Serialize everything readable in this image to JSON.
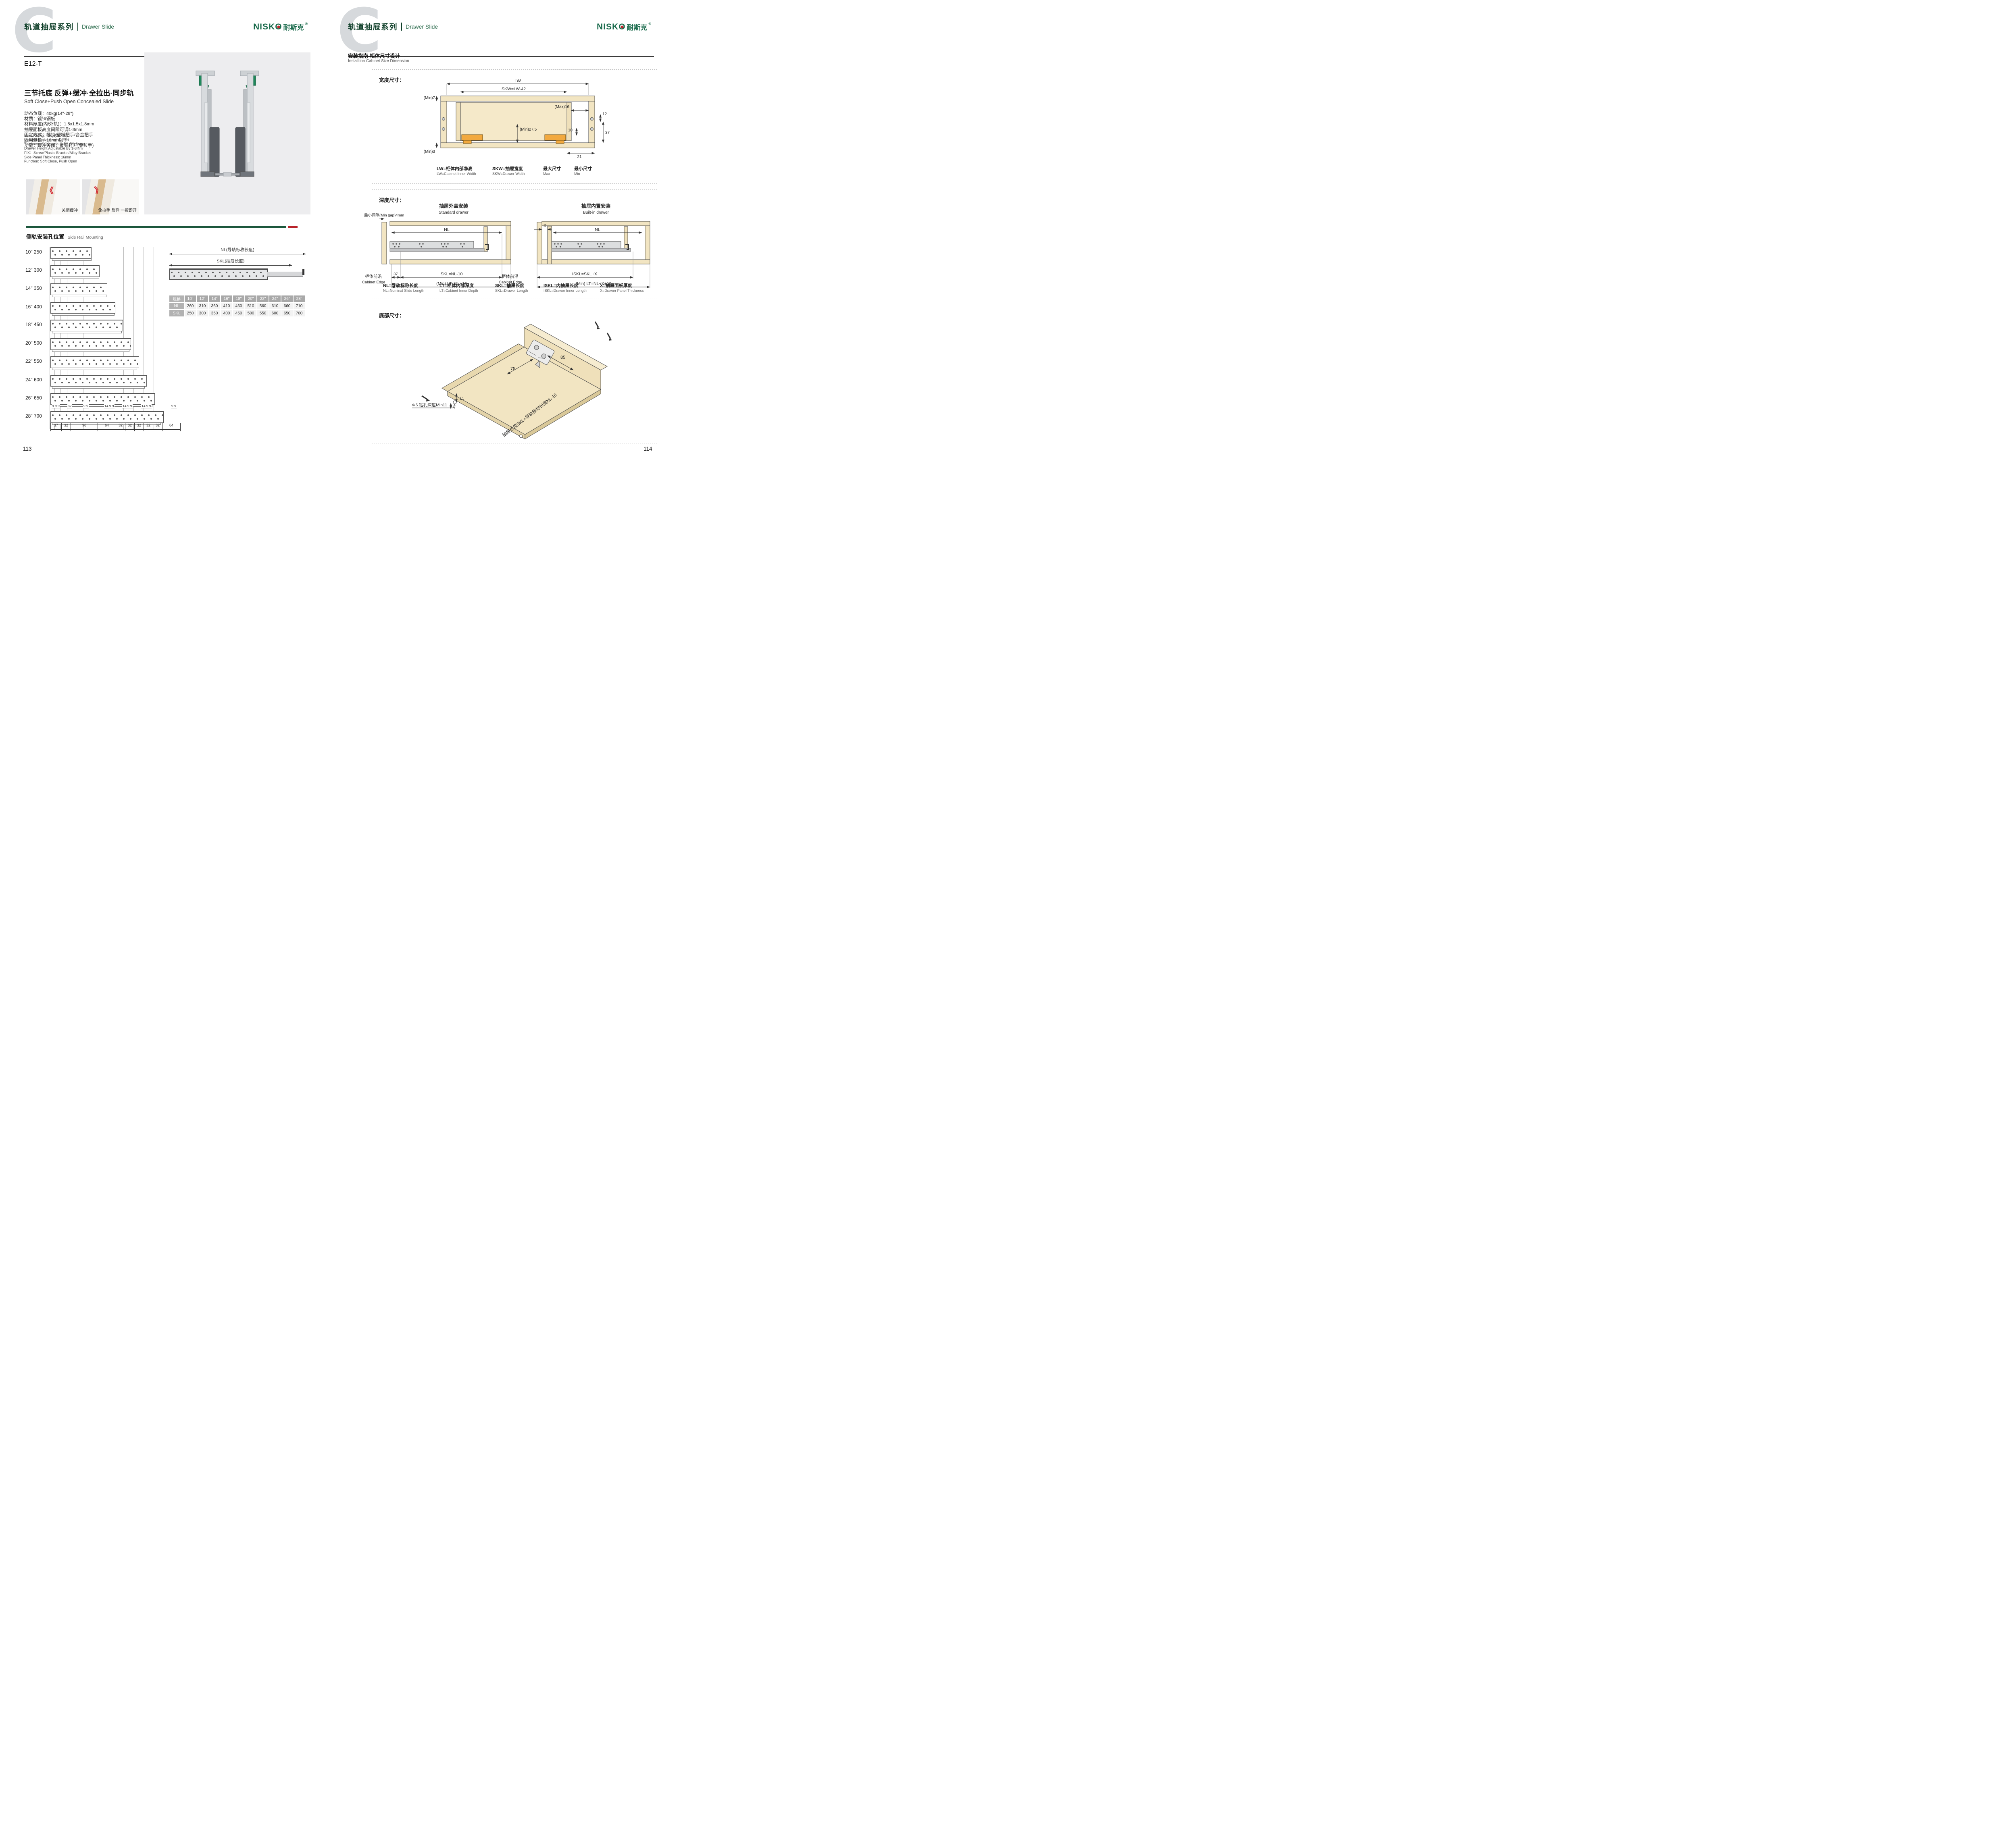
{
  "header": {
    "watermark": "C",
    "series_cn": "轨道抽屉系列",
    "series_en": "Drawer Slide"
  },
  "logo": {
    "en_head": "NISK",
    "en_o": "O",
    "cn": "耐斯克",
    "reg": "®"
  },
  "colors": {
    "brand_green": "#1a6b4c",
    "header_green": "#10402a",
    "rule_green": "#174f36",
    "accent_red": "#b8232a",
    "wood_tan": "#f2e5c2",
    "bracket_orange": "#f2a93f",
    "table_gray": "#a9a9a9"
  },
  "left_page": {
    "page_number": "113",
    "model": "E12-T",
    "title_cn": "三节托底 反弹+缓冲·全拉出·同步轨",
    "title_en": "Soft Close+Push Open Concealed Slide",
    "specs_cn": [
      "动态负载：40kg(14\"-28\")",
      "材质：镀锌钢板",
      "材料厚度(内/外轨)：1.5x1.5x1.8mm",
      "抽屉面板高度间隙可调1-3mm",
      "固定方式：插销/塑料把手/合金把手",
      "适用侧板：16mm以下",
      "功能：缓冲关闭，反弹打开(免拉手)"
    ],
    "specs_en": [
      "Load Rating: 40kg (14\"-28)",
      "Material: Galvanized Sheed",
      "Thickness Of Materia (1.5/1.5/1.8mm)",
      "Drawer Height Adjustable By 1-3mm",
      "FIX：Screw/Plastic Bracket/Alloy Bracket",
      "Side Panel Thickness: 16mm",
      "Function: Soft Close, Push Open"
    ],
    "photo_captions": [
      "关闭缓冲",
      "免拉手 反弹 一按即开"
    ],
    "rail_section": {
      "cn": "侧轨安装孔位置",
      "en": "Side Rail Mounting"
    },
    "rail_rows": [
      {
        "inch": "10\"",
        "mm": "250"
      },
      {
        "inch": "12\"",
        "mm": "300"
      },
      {
        "inch": "14\"",
        "mm": "350"
      },
      {
        "inch": "16\"",
        "mm": "400"
      },
      {
        "inch": "18\"",
        "mm": "450"
      },
      {
        "inch": "20\"",
        "mm": "500"
      },
      {
        "inch": "22\"",
        "mm": "550"
      },
      {
        "inch": "24\"",
        "mm": "600"
      },
      {
        "inch": "26\"",
        "mm": "650"
      },
      {
        "inch": "28\"",
        "mm": "700"
      }
    ],
    "rail_top_dims": [
      "9 9 9",
      "32",
      "9 9",
      "14 9 9",
      "14 9 9",
      "14 9 9",
      "9 9"
    ],
    "rail_bottom_dims": [
      37,
      32,
      96,
      64,
      32,
      32,
      32,
      32,
      32,
      64
    ],
    "slide_dims": {
      "nl": "NL(导轨标称长度)",
      "skl": "SKL(抽屉长度)"
    },
    "size_table": {
      "spec_label": "规格",
      "cols": [
        "10\"",
        "12\"",
        "14\"",
        "16\"",
        "18\"",
        "20\"",
        "22\"",
        "24\"",
        "26\"",
        "28\""
      ],
      "nl_label": "NL",
      "nl": [
        260,
        310,
        360,
        410,
        460,
        510,
        560,
        610,
        660,
        710
      ],
      "skl_label": "SKL",
      "skl": [
        250,
        300,
        350,
        400,
        450,
        500,
        550,
        600,
        650,
        700
      ]
    }
  },
  "right_page": {
    "page_number": "114",
    "guide_title_cn": "安装指南-柜体尺寸设计",
    "guide_title_en": "Installtion Cabinet Size Dimension",
    "width_box": {
      "title": "宽度尺寸：",
      "dims": {
        "lw": "LW",
        "skw": "SKW=LW-42",
        "min7": "(Min)7",
        "max16": "(Max)16",
        "d12": "12",
        "d10": "10",
        "d37": "37",
        "min275": "(Min)27.5",
        "min3": "(Min)3",
        "d21": "21"
      },
      "legend": [
        {
          "cn": "LW=柜体内部净高",
          "en": "LW=Cabinet Inner Width"
        },
        {
          "cn": "SKW=抽屉宽度",
          "en": "SKW=Drawer Width"
        },
        {
          "cn": "最大尺寸",
          "en": "Max"
        },
        {
          "cn": "最小尺寸",
          "en": "Min"
        }
      ]
    },
    "depth_box": {
      "title": "深度尺寸：",
      "gap_label": "最小间隙(Min gap)4mm",
      "standard": {
        "cn": "抽屉外盖安装",
        "en": "Standard drawer",
        "nl": "NL",
        "d37": "37",
        "skl": "SKL=NL-10",
        "lt": "(Min) LT=NL+10",
        "edge_cn": "柜体前沿",
        "edge_en": "Cabinet Edge"
      },
      "builtin": {
        "cn": "抽屉内置安装",
        "en": "Built-in drawer",
        "x": "X",
        "nl": "NL",
        "iskl": "ISKL=SKL+X",
        "lt": "(Min) LT=NL+X+10",
        "edge_cn": "柜体前沿",
        "edge_en": "Cabinet Edge"
      },
      "legend": [
        {
          "cn": "NL=导轨标称长度",
          "en": "NL=Nominal Slide Length"
        },
        {
          "cn": "LT=柜体内部深度",
          "en": "LT=Cabinet Inner Depth"
        },
        {
          "cn": "SKL=抽屉长度",
          "en": "SKL=Drawer Length"
        },
        {
          "cn": "ISKL=内抽屉长度",
          "en": "ISKL=Drawer Inner Length"
        },
        {
          "cn": "X=抽屉面板厚度",
          "en": "X=Drawer Panel Thickness"
        }
      ]
    },
    "bottom_box": {
      "title": "底部尺寸：",
      "d75": "75",
      "d85": "85",
      "d11": "11",
      "d7": "7",
      "drill": "Φ6 钻孔深度Min11",
      "rotated": "抽屉长度SKL=导轨标称长度NL-10"
    }
  }
}
